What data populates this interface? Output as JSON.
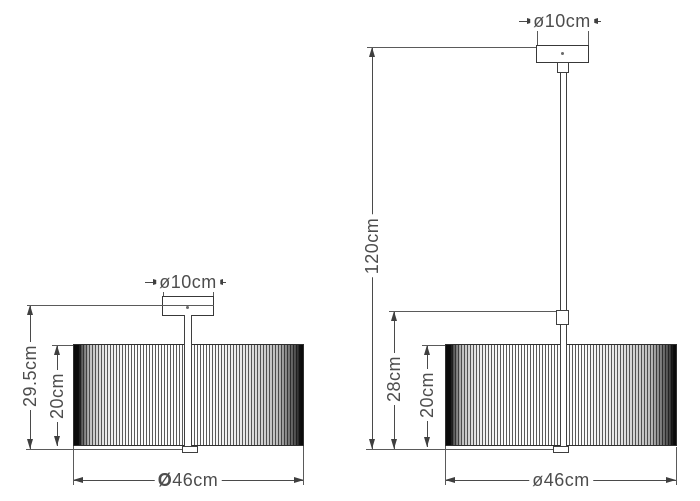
{
  "left_lamp": {
    "canopy_diameter": "ø10cm",
    "overall_height": "29.5cm",
    "shade_height": "20cm",
    "diameter_symbol": "Ø",
    "diameter_value": "46cm"
  },
  "right_lamp": {
    "canopy_diameter": "ø10cm",
    "suspension_length": "120cm",
    "body_height": "28cm",
    "shade_height": "20cm",
    "diameter": "ø46cm"
  },
  "colors": {
    "line": "#4a4a4a",
    "outline": "#333333",
    "text": "#4d4d4d",
    "background": "#ffffff"
  }
}
